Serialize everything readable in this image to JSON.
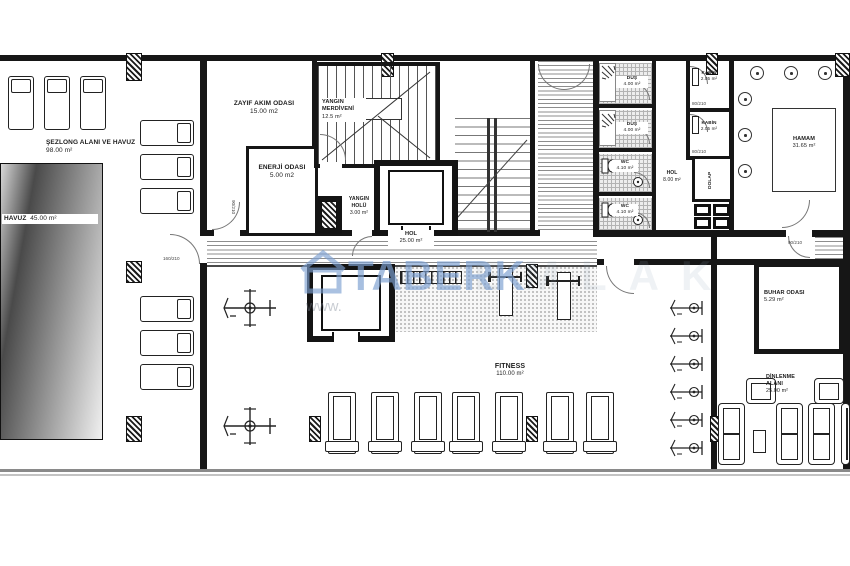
{
  "rooms": {
    "sezlong": {
      "name": "ŞEZLONG ALANI VE HAVUZ",
      "area": "98.00 m²"
    },
    "havuz": {
      "name": "HAVUZ",
      "area": "45.00 m²"
    },
    "zayif": {
      "name": "ZAYIF AKIM ODASI",
      "area": "15.00 m2"
    },
    "enerji": {
      "name": "ENERJİ ODASI",
      "area": "5.00 m2"
    },
    "yanginMerdiven": {
      "name": "YANGIN MERDİVENİ",
      "area": "12.5 m²"
    },
    "yanginHolu": {
      "name": "YANGIN HOLÜ",
      "area": "3.00 m²"
    },
    "hol": {
      "name": "HOL",
      "area": "25.00 m²"
    },
    "dus1": {
      "name": "DUŞ",
      "area": "4.00 m²"
    },
    "dus2": {
      "name": "DUŞ",
      "area": "4.00 m²"
    },
    "wc1": {
      "name": "WC",
      "area": "4.10 m²"
    },
    "wc2": {
      "name": "WC",
      "area": "4.10 m²"
    },
    "hol2": {
      "name": "HOL",
      "area": "8.00 m²"
    },
    "kabin1": {
      "name": "KABİN",
      "area": "2.05 m²"
    },
    "kabin2": {
      "name": "KABİN",
      "area": "2.05 m²"
    },
    "dolap": {
      "name": "DOLAP"
    },
    "hamam": {
      "name": "HAMAM",
      "area": "31.65 m²"
    },
    "buhar": {
      "name": "BUHAR ODASI",
      "area": "5.29 m²"
    },
    "dinlenme": {
      "name": "DİNLENME ALANI",
      "area": "25.00 m²"
    },
    "fitness": {
      "name": "FITNESS",
      "area": "110.00 m²"
    }
  },
  "door_tags": {
    "standard": "90/210",
    "kabin": "80/210",
    "wide": "160/210"
  },
  "watermark": {
    "brand": "TABERK",
    "brand_faint": "EMLAK",
    "url": "www."
  },
  "colors": {
    "wall": "#161616",
    "watermark_blue": "#7da0d2",
    "pool_dark": "#4a4a4a",
    "pool_light": "#f0f0f0"
  }
}
